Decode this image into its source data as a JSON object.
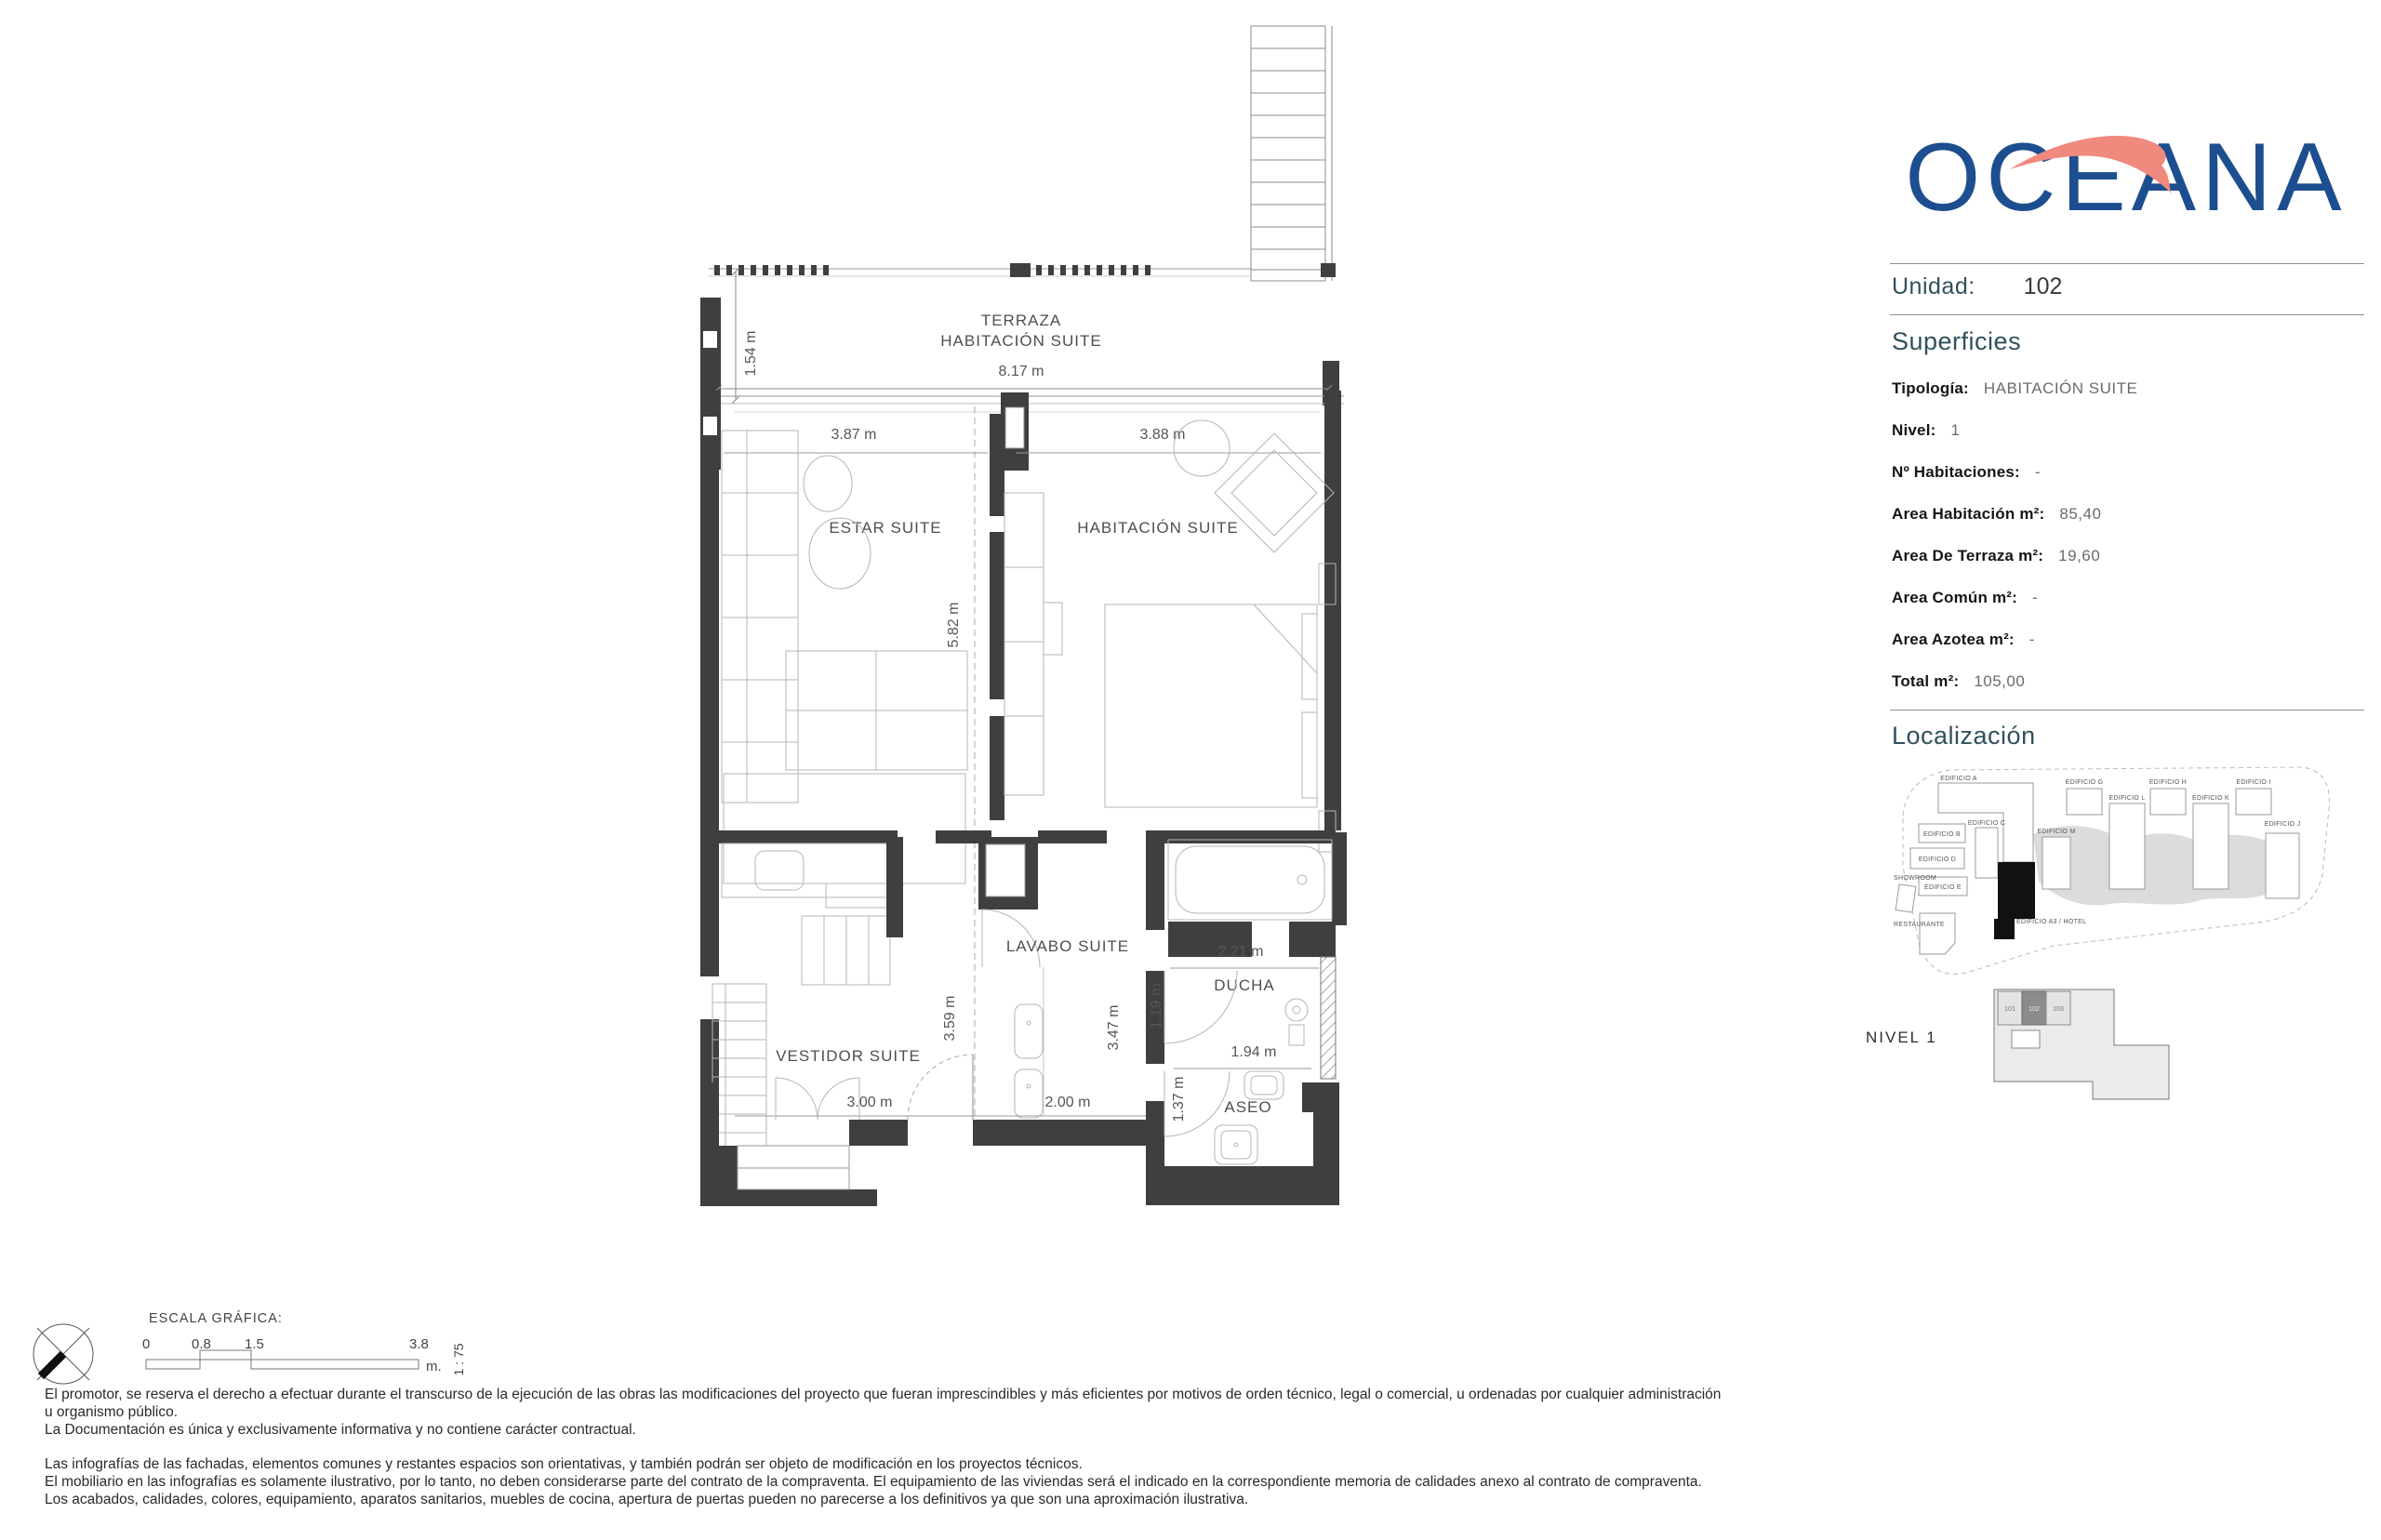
{
  "logo": {
    "text": "OCEANA",
    "blue": "#1d4e8f",
    "coral": "#f0897e"
  },
  "unit_header": {
    "label": "Unidad:",
    "value": "102"
  },
  "superficies": {
    "title": "Superficies",
    "rows": [
      {
        "label": "Tipología:",
        "value": "HABITACIÓN SUITE"
      },
      {
        "label": "Nivel:",
        "value": "1"
      },
      {
        "label": "Nº Habitaciones:",
        "value": "-"
      },
      {
        "label": "Area Habitación m²:",
        "value": "85,40"
      },
      {
        "label": "Area De Terraza m²:",
        "value": "19,60"
      },
      {
        "label": "Area Común m²:",
        "value": "-"
      },
      {
        "label": "Area Azotea m²:",
        "value": "-"
      },
      {
        "label": "Total m²:",
        "value": "105,00"
      }
    ]
  },
  "localizacion": {
    "title": "Localización",
    "buildings": [
      "EDIFICIO A",
      "EDIFICIO C",
      "EDIFICIO B",
      "EDIFICIO D",
      "EDIFICIO E",
      "SHOWROOM",
      "RESTAURANTE",
      "EDIFICIO A3 / HOTEL",
      "EDIFICIO M",
      "EDIFICIO G",
      "EDIFICIO L",
      "EDIFICIO H",
      "EDIFICIO K",
      "EDIFICIO I",
      "EDIFICIO J"
    ]
  },
  "nivel_plan": {
    "label": "NIVEL 1",
    "cells": [
      "101",
      "102",
      "103"
    ],
    "highlighted": "102"
  },
  "plan": {
    "terraza1": "TERRAZA",
    "terraza2": "HABITACIÓN SUITE",
    "terraza_w": "8.17 m",
    "terraza_h": "1.54 m",
    "estar": "ESTAR SUITE",
    "estar_w": "3.87 m",
    "hab": "HABITACIÓN SUITE",
    "hab_w": "3.88 m",
    "center_h": "5.82 m",
    "lavabo": "LAVABO SUITE",
    "lavabo_h": "3.47 m",
    "lavabo_w": "2.00 m",
    "vestidor": "VESTIDOR SUITE",
    "vestidor_h": "3.59 m",
    "vestidor_w": "3.00 m",
    "ducha": "DUCHA",
    "ducha_w": "2.21 m",
    "ducha_h": "1.19 m",
    "aseo": "ASEO",
    "aseo_w": "1.94 m",
    "aseo_h": "1.37 m"
  },
  "scale_bar": {
    "title": "ESCALA GRÁFICA:",
    "t0": "0",
    "t1": "0.8",
    "t2": "1.5",
    "t3": "3.8",
    "unit": "m.",
    "ratio": "1 : 75"
  },
  "disclaimer": {
    "p1": [
      "El promotor, se reserva el derecho a efectuar durante el transcurso de la ejecución de las obras las modificaciones del proyecto que fueran imprescindibles y más eficientes por motivos de orden técnico, legal o comercial, u ordenadas por cualquier administración",
      "u organismo público.",
      "La Documentación es única y exclusivamente informativa y no contiene carácter contractual."
    ],
    "p2": [
      "Las infografías de las fachadas, elementos comunes y restantes espacios son orientativas, y también podrán ser objeto de modificación en los proyectos técnicos.",
      "El mobiliario en las infografías es solamente ilustrativo, por lo tanto, no deben considerarse parte del contrato de la compraventa. El equipamiento de las viviendas será el indicado en la correspondiente memoria de calidades anexo al contrato de compraventa.",
      "Los acabados, calidades, colores, equipamiento, aparatos sanitarios, muebles de cocina, apertura de puertas pueden no parecerse a los definitivos ya que son una aproximación ilustrativa."
    ]
  }
}
